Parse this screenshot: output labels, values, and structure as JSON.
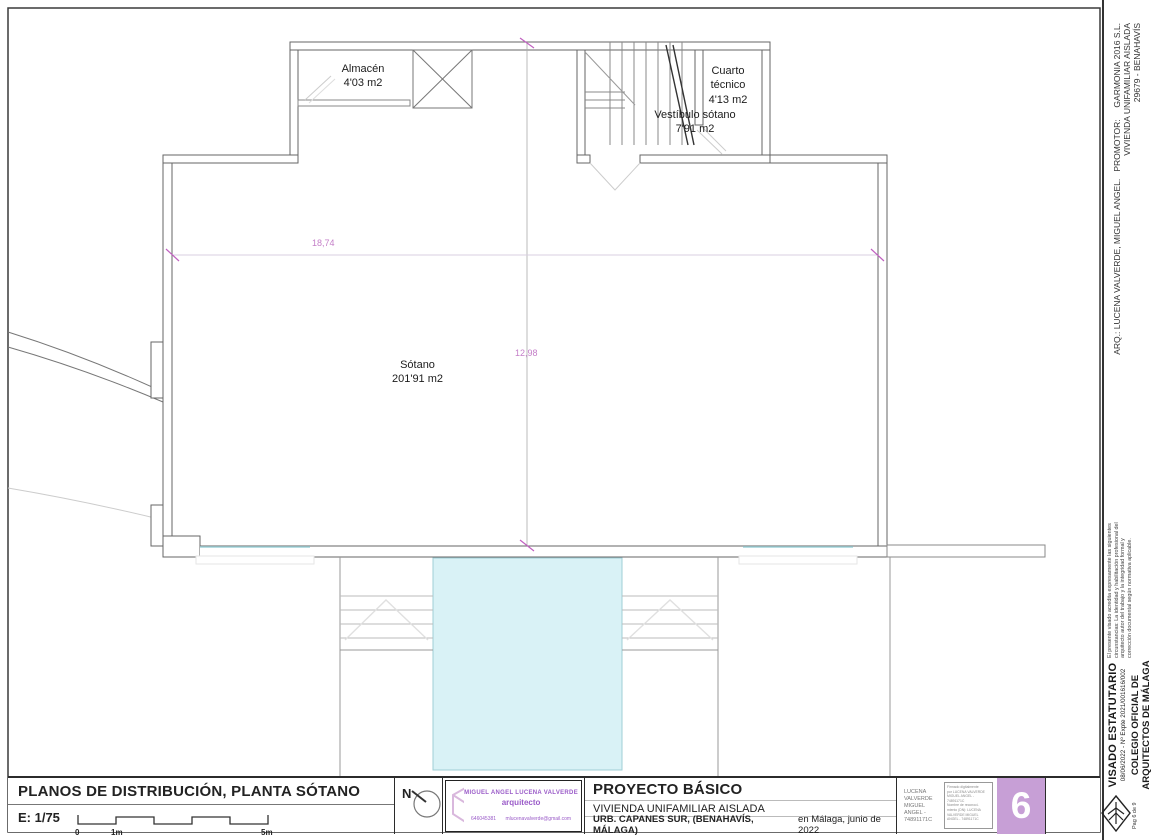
{
  "colors": {
    "dim_magenta": "#c47fc8",
    "pool_fill": "#d9f2f6",
    "stamp_violet": "#9a5bc8",
    "sheet_number_bg": "#c79fd6"
  },
  "plan": {
    "rooms": {
      "almacen": {
        "name": "Almacén",
        "area": "4'03 m2"
      },
      "vestibulo": {
        "name": "Vestíbulo sótano",
        "area": "7'91 m2"
      },
      "cuarto": {
        "name": "Cuarto técnico",
        "area": "4'13 m2"
      },
      "sotano": {
        "name": "Sótano",
        "area": "201'91 m2"
      }
    },
    "dimensions": {
      "width": "18,74",
      "height": "12,98"
    }
  },
  "title_block": {
    "title": "PLANOS DE DISTRIBUCIÓN, PLANTA SÓTANO",
    "scale": "E: 1/75",
    "scale_marks": {
      "zero": "0",
      "one": "1m",
      "five": "5m"
    },
    "north_label": "N",
    "stamp": {
      "architect": "MIGUEL ANGEL LUCENA VALVERDE",
      "role": "arquitecto",
      "phone": "646045381",
      "email": "mlucenavalverde@gmail.com"
    },
    "project": {
      "type": "PROYECTO BÁSICO",
      "subtitle": "VIVIENDA UNIFAMILIAR AISLADA",
      "address": "URB. CAPANES SUR, (BENAHAVÍS, MÁLAGA)",
      "date": "en Málaga, junio de 2022"
    },
    "signature": {
      "name_lines": [
        "LUCENA",
        "VALVERDE",
        "MIGUEL",
        "ANGEL -",
        "74891171C"
      ],
      "digital_lines": [
        "Firmado digitalmente",
        "por LUCENA VALVERDE",
        "MIGUEL ANGEL -",
        "74891171C",
        "Nombre de reconoci-",
        "miento (DN): LUCENA",
        "VALVERDE MIGUEL",
        "ANGEL - 74891171C"
      ]
    },
    "sheet_number": "6"
  },
  "sidebar": {
    "registration": {
      "line1": "ARQ.: LUCENA VALVERDE, MIGUEL ANGEL.   PROMOTOR:     GARMONIA 2016 S.L.",
      "line2": "VIVIENDA UNIFAMILIAR AISLADA",
      "line3": "29679 - BENAHAVÍS"
    },
    "visado_note_lines": [
      "El presente visado acredita expresamente las siguientes",
      "circunstancias: La identidad y habilitación profesional del",
      "arquitecto autor del trabajo y la integridad formal y",
      "corrección documental según normativa aplicable."
    ],
    "visado_title": "VISADO ESTATUTARIO",
    "visado_ref": "08/06/2022 - Nº Expte 2021/001616/002",
    "colegio_line1": "COLEGIO OFICIAL DE",
    "colegio_line2": "ARQUITECTOS DE MÁLAGA",
    "page": "Pag 6 de 9"
  }
}
